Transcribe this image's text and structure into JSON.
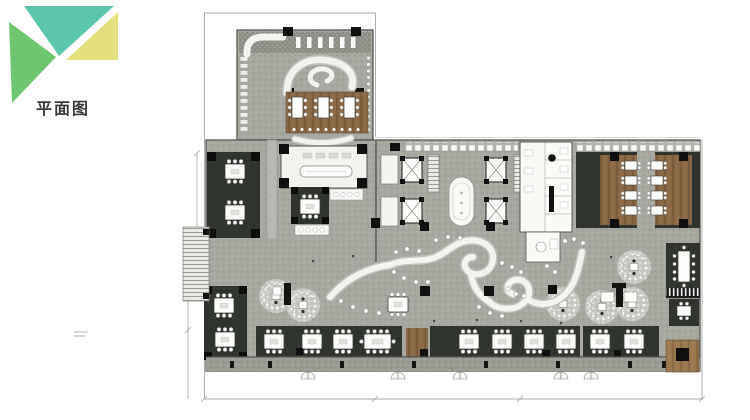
{
  "logo": {
    "triangles": [
      {
        "name": "top",
        "color": "#5cc7ac"
      },
      {
        "name": "right",
        "color": "#e5e07e"
      },
      {
        "name": "left",
        "color": "#6fc671"
      }
    ]
  },
  "title": {
    "text": "平面图",
    "color": "#3a3a3a"
  },
  "plan": {
    "palette": {
      "floor": "#a7a9a1",
      "floor_dot": "#92948c",
      "dark": "#30342e",
      "wood": "#8a6845",
      "wood_light": "#9a7850",
      "circle_zone": "#c9cbc3",
      "white_feature": "#f3f3ef",
      "wall_line": "#565954",
      "boundary_line": "#a8a8a6",
      "column": "#101010"
    }
  }
}
